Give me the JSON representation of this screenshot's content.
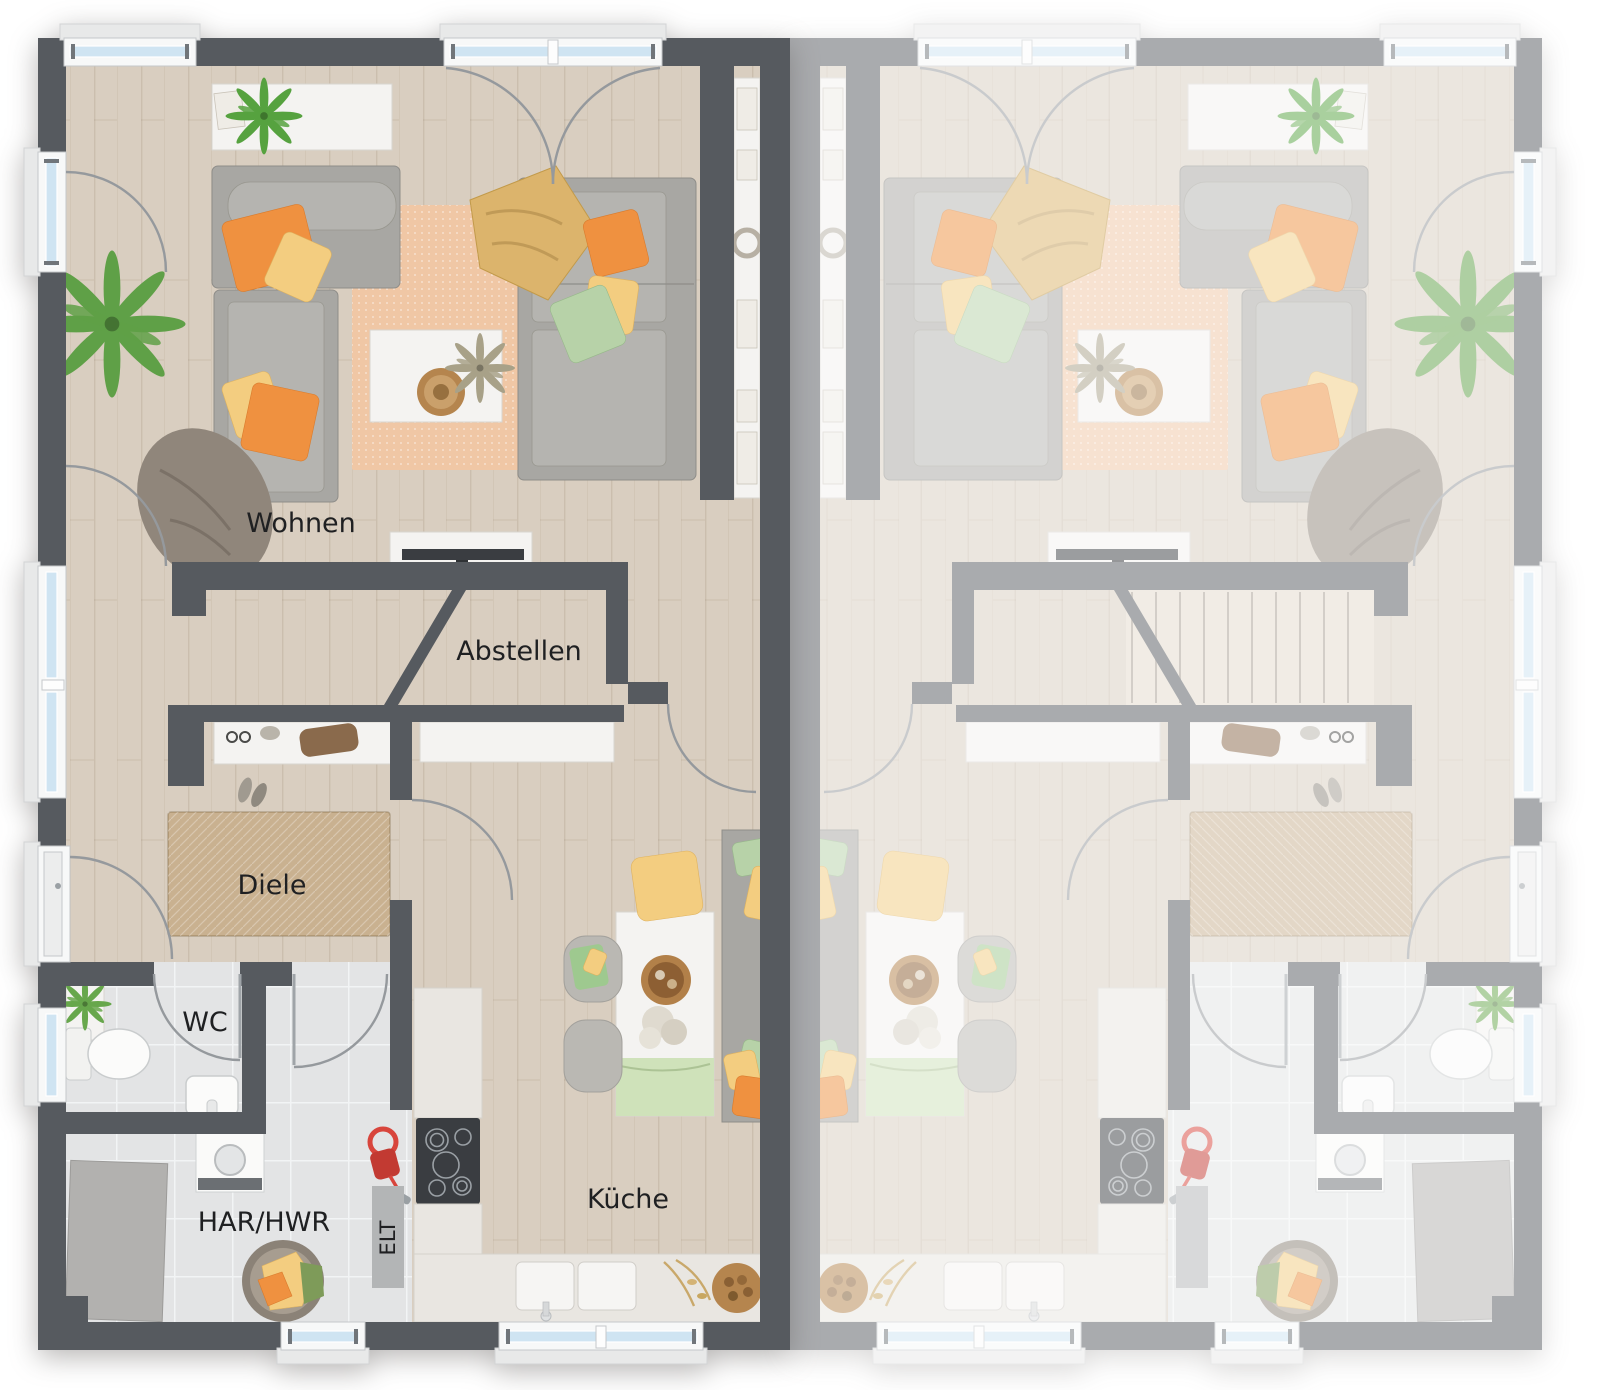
{
  "floorplan": {
    "room_labels": {
      "wohnen": "Wohnen",
      "abstellen": "Abstellen",
      "diele": "Diele",
      "wc": "WC",
      "har_hwr": "HAR/HWR",
      "elt": "ELT",
      "kueche": "Küche"
    },
    "right_unit_opacity": 0.5,
    "colors": {
      "wall_dark": "#565a5f",
      "floor_wood": "#d9cec0",
      "tile": "#e3e4e5",
      "rug_living": "#f0c7a5",
      "rug_jute": "#c9b190",
      "sofa": "#a8a7a3",
      "white_furn": "#f4f3f1",
      "counter": "#e9e6e1",
      "appliance_dark": "#3a3d41",
      "accent_orange": "#ef9140",
      "accent_yellow": "#f3cd80",
      "accent_green": "#b7d2a8",
      "accent_red": "#d8453c",
      "plant_green": "#5fa047",
      "glass_blue": "#cfe4f2",
      "arc_gray": "#95999d",
      "label_dark": "#1f2022",
      "elt_panel": "#b3b5b6"
    }
  }
}
